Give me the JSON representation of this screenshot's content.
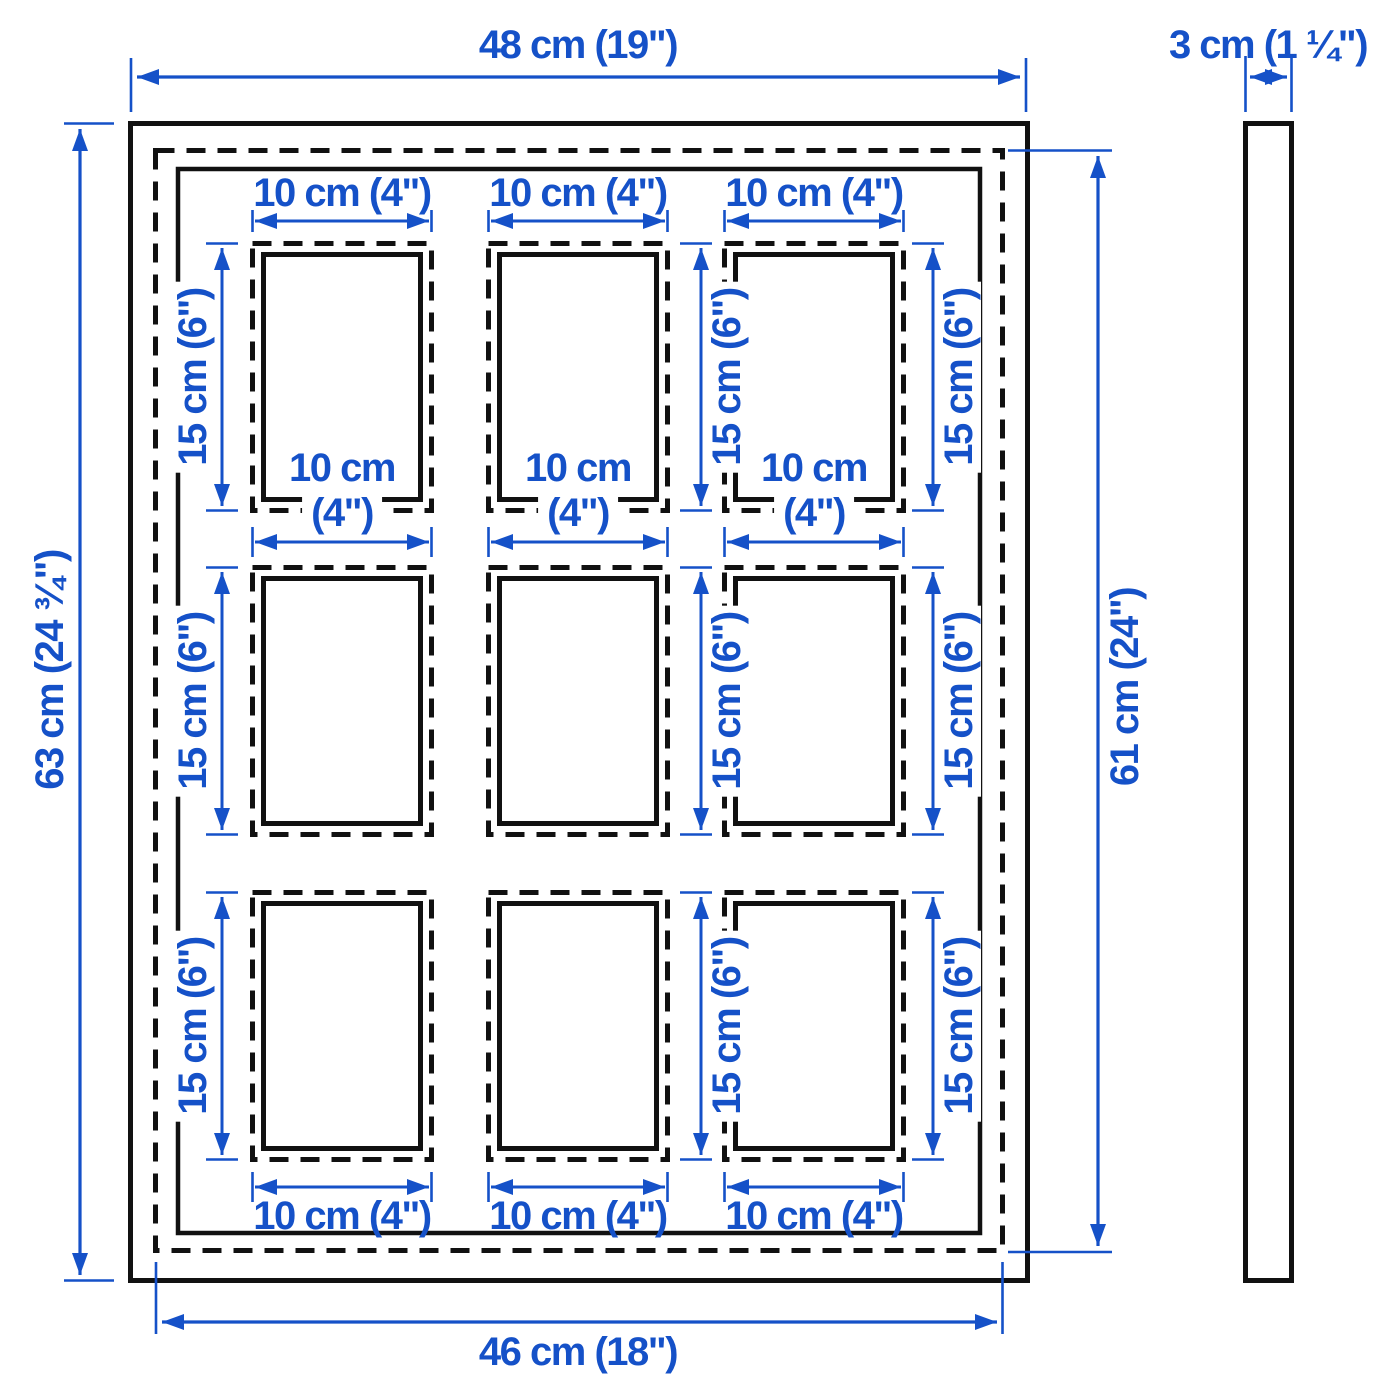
{
  "diagram": {
    "kind": "product dimension drawing",
    "product": "collage frame for 9 photos, front view and side view",
    "colors": {
      "dimension_blue": "#1551C8",
      "outline_black": "#111111",
      "background": "#FFFFFF"
    },
    "front_view": {
      "overall_width": "48 cm (19\")",
      "overall_height": "63 cm (24 ¾\")",
      "visible_width": "46 cm (18\")",
      "visible_height": "61 cm (24\")",
      "opening": {
        "width": "10 cm (4\")",
        "width_line1": "10 cm",
        "width_line2": "(4\")",
        "height": "15 cm (6\")"
      },
      "opening_count": 9,
      "grid": "3 × 3"
    },
    "side_view": {
      "depth": "3 cm (1 ¼\")"
    }
  }
}
